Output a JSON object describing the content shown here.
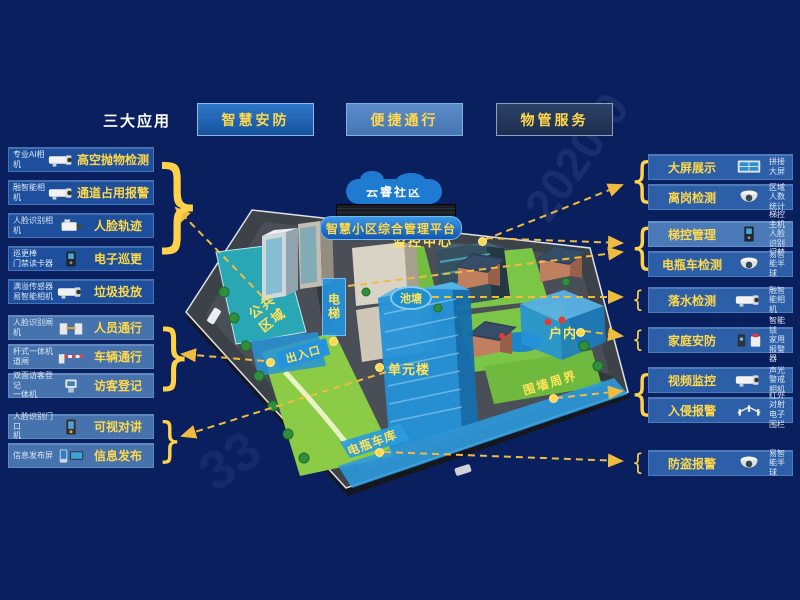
{
  "header": {
    "section_label": "三大应用",
    "apps": [
      {
        "label": "智慧安防"
      },
      {
        "label": "便捷通行"
      },
      {
        "label": "物管服务"
      }
    ]
  },
  "colors": {
    "background": "#0a1f5e",
    "accent_yellow": "#ffd84b",
    "row_blue": "#1d4f9c",
    "row_blue_light": "#4673ae",
    "row_blue_right": "#2c5fa7",
    "highlight_blue": "#2b9bdf",
    "arrow_yellow": "#f0bc3e"
  },
  "left_panel": {
    "groups": [
      {
        "name": "community-monitoring",
        "tone": "dark",
        "rows": [
          {
            "device": "专业AI相机",
            "feature": "高空抛物检测",
            "icon": "bullet-camera"
          },
          {
            "device": "融智能相机",
            "feature": "通道占用报警",
            "icon": "bullet-camera"
          },
          {
            "device": "人脸识别相机",
            "feature": "人脸轨迹",
            "icon": "box-camera"
          },
          {
            "device": "巡更棒\n门禁读卡器",
            "feature": "电子巡更",
            "icon": "access-panel"
          },
          {
            "device": "满溢传感器\n易智能相机",
            "feature": "垃圾投放",
            "icon": "bullet-camera"
          }
        ]
      },
      {
        "name": "entrance-access",
        "tone": "light",
        "rows": [
          {
            "device": "人脸识别闸机",
            "feature": "人员通行",
            "icon": "turnstile"
          },
          {
            "device": "杆式一体机\n道闸",
            "feature": "车辆通行",
            "icon": "barrier-gate"
          },
          {
            "device": "双面访客登记\n一体机",
            "feature": "访客登记",
            "icon": "kiosk"
          }
        ]
      },
      {
        "name": "unit-building",
        "tone": "light",
        "rows": [
          {
            "device": "人脸识别门口\n机",
            "feature": "可视对讲",
            "icon": "door-station"
          },
          {
            "device": "信息发布屏",
            "feature": "信息发布",
            "icon": "signage-screen"
          }
        ]
      }
    ]
  },
  "right_panel": {
    "groups": [
      {
        "name": "monitoring-center",
        "rows": [
          {
            "feature": "大屏展示",
            "device": "拼接大屏",
            "icon": "video-wall"
          },
          {
            "feature": "离岗检测",
            "device": "区域人数统计",
            "icon": "dome-camera"
          }
        ]
      },
      {
        "name": "elevator",
        "rows": [
          {
            "feature": "梯控管理",
            "device": "梯控主机\n人脸识别门禁",
            "icon": "elevator-panel",
            "tone": "light"
          },
          {
            "feature": "电瓶车检测",
            "device": "易智能半球",
            "icon": "dome-camera"
          }
        ]
      },
      {
        "name": "pond",
        "rows": [
          {
            "feature": "落水检测",
            "device": "融智能相机",
            "icon": "bullet-camera"
          }
        ]
      },
      {
        "name": "home",
        "rows": [
          {
            "feature": "家庭安防",
            "device": "智能锁\n家用报警器",
            "icon": "lock-siren"
          }
        ]
      },
      {
        "name": "perimeter",
        "rows": [
          {
            "feature": "视频监控",
            "device": "声光警戒相机",
            "icon": "bullet-camera"
          },
          {
            "feature": "入侵报警",
            "device": "红外对射\n电子围栏",
            "icon": "fence"
          }
        ]
      },
      {
        "name": "garage",
        "rows": [
          {
            "feature": "防盗报警",
            "device": "易智能半球",
            "icon": "dome-camera"
          }
        ]
      }
    ]
  },
  "map": {
    "cloud": "云睿社区",
    "platform": "智慧小区综合管理平台",
    "zones": {
      "monitoring_center": "监控中心",
      "elevator": "电梯",
      "pond": "池塘",
      "public_area": "公共区域",
      "entrance": "出入口",
      "unit_building": "单元楼",
      "indoor": "户内",
      "perimeter": "围墙周界",
      "ebike_garage": "电瓶车库"
    }
  },
  "watermark": {
    "top": "2020-0",
    "bottom": "33"
  }
}
